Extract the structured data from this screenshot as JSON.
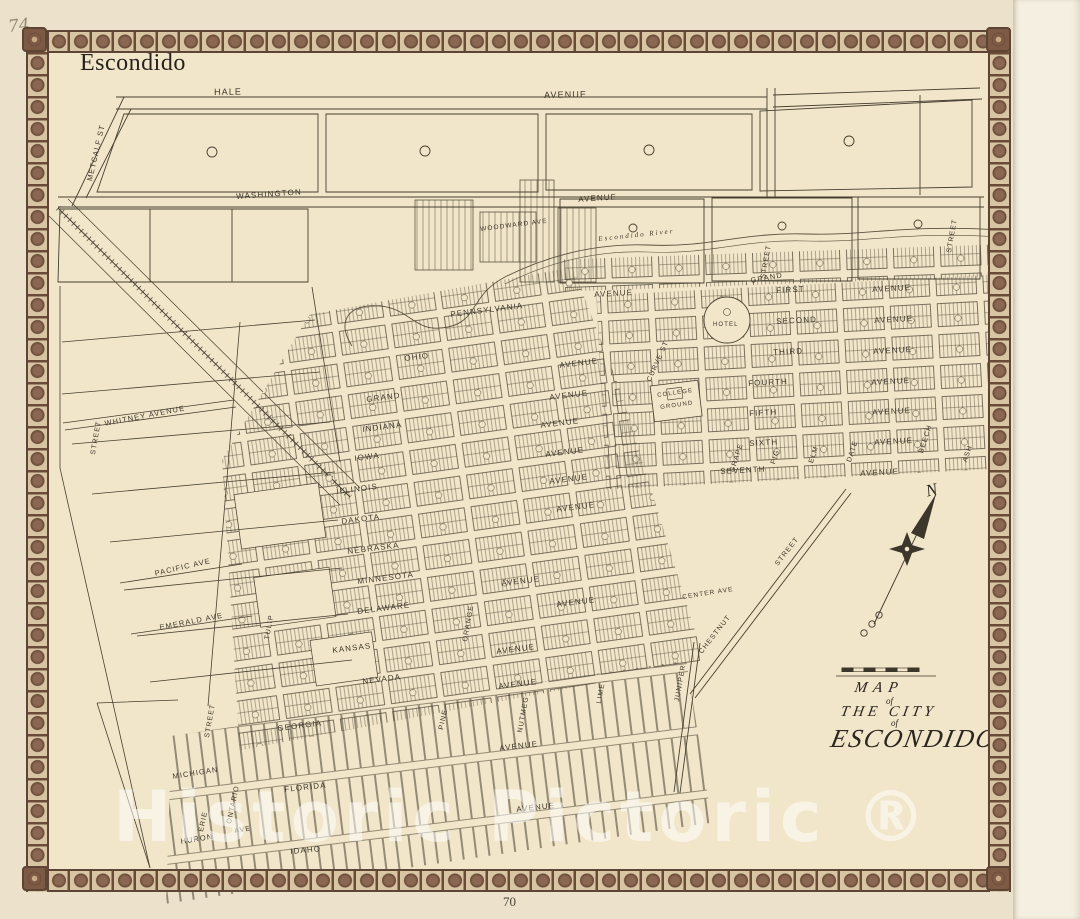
{
  "page": {
    "handwritten_number": "74",
    "sheet_title": "Escondido",
    "page_number": "70",
    "watermark": "Historic Pictoric ®"
  },
  "title_block": {
    "line1": "MAP",
    "line2": "of",
    "line3": "THE CITY",
    "line4": "of",
    "line5": "ESCONDIDO"
  },
  "compass": {
    "north": "N"
  },
  "map": {
    "river": "Escondido River",
    "street_labels": [
      "HALE",
      "AVENUE",
      "METCALF ST",
      "WASHINGTON",
      "AVENUE",
      "WOODWARD AVE",
      "STREET",
      "STREET",
      "GRAND",
      "FIRST",
      "AVENUE",
      "SECOND",
      "AVENUE",
      "THIRD",
      "AVENUE",
      "FOURTH",
      "AVENUE",
      "FIFTH",
      "AVENUE",
      "SIXTH",
      "AVENUE",
      "SEVENTH",
      "AVENUE",
      "HOTEL",
      "COLLEGE",
      "GROUND",
      "CURVE ST",
      "GRAPE",
      "FIG",
      "ELM",
      "DATE",
      "BEECH",
      "ASH",
      "PENNSYLVANIA",
      "AVENUE",
      "OHIO",
      "AVENUE",
      "GRAND",
      "AVENUE",
      "INDIANA",
      "AVENUE",
      "IOWA",
      "AVENUE",
      "ILLINOIS",
      "AVENUE",
      "DAKOTA",
      "AVENUE",
      "NEBRASKA",
      "MINNESOTA",
      "AVENUE",
      "DELAWARE",
      "AVENUE",
      "KANSAS",
      "AVENUE",
      "NEVADA",
      "AVENUE",
      "GEORGIA",
      "AVENUE",
      "FLORIDA",
      "AVENUE",
      "IDAHO",
      "MICHIGAN",
      "HURON",
      "ERIE",
      "ONTARIO",
      "AVE",
      "TULIP",
      "PINE",
      "JUNIPER",
      "WHITNEY AVENUE",
      "PACIFIC AVE",
      "EMERALD AVE",
      "STREET",
      "STREET",
      "CENTER AVE",
      "CHESTNUT",
      "STREET",
      "ORANGE",
      "NUTMEG",
      "LIME"
    ]
  },
  "colors": {
    "paper": "#f1e6c9",
    "ink": "#474031",
    "border_brown": "#7c5a44",
    "watermark_white": "rgba(255,255,255,0.52)"
  }
}
